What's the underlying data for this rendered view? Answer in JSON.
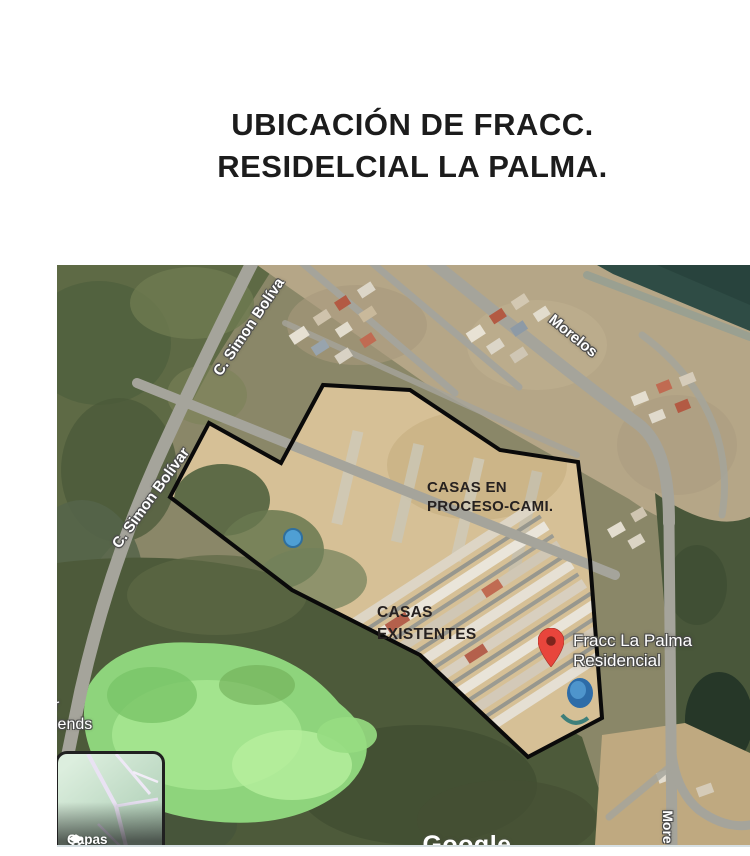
{
  "page": {
    "title_line1": "UBICACIÓN DE FRACC.",
    "title_line2": "RESIDELCIAL LA PALMA."
  },
  "map": {
    "zone_labels": {
      "in_progress": {
        "line1": "CASAS EN",
        "line2": "PROCESO-CAMI."
      },
      "existing": {
        "line1": "CASAS",
        "line2": "EXISTENTES"
      }
    },
    "place_marker": {
      "line1": "Fracc La Palma",
      "line2": "Residencial",
      "pin_color": "#e8453c"
    },
    "street_labels": {
      "simon_bolivar_top": "C. Simon Bolíva",
      "simon_bolivar_left": "C. Simon Bolívar",
      "morelos": "Morelos",
      "morelos_bottom": "More"
    },
    "edge_label": {
      "line1": "r",
      "line2": "iends"
    },
    "layers_button": "Capas",
    "watermark": "Google",
    "boundary_color": "#000000"
  }
}
